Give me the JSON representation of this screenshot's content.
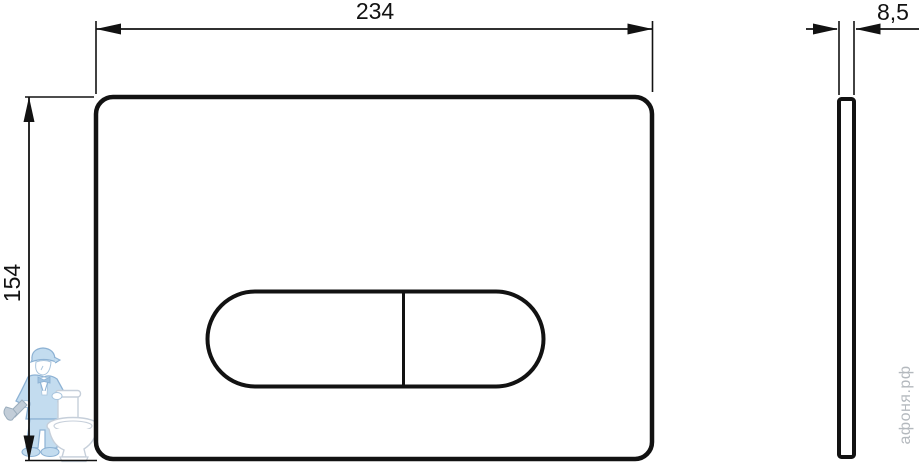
{
  "page": {
    "background": "#ffffff",
    "line_color": "#121212"
  },
  "dimensions": {
    "width": "234",
    "height": "154",
    "thickness": "8,5"
  },
  "watermark": {
    "site": "афоня.рф",
    "mascot_icon": "plumber-with-toilet-icon",
    "mascot_blue": "#c3dcef",
    "mascot_outline": "#8db2d4",
    "toilet_outline": "#c6cfda",
    "text_color": "#b4b9be"
  }
}
